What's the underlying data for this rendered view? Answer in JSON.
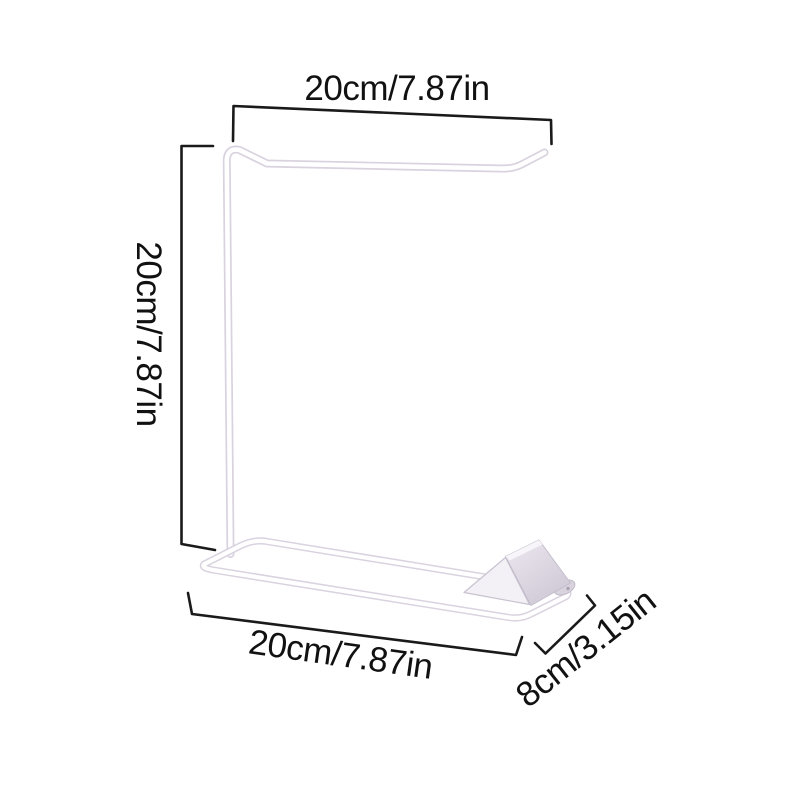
{
  "page": {
    "background_color": "#ffffff",
    "description": "Product dimension diagram of a white metal wire bag/towel stand"
  },
  "product": {
    "name": "white-wire-stand",
    "wire_outline_color": "#d9d2df",
    "wire_fill_color": "#ffffff",
    "plate_light_color": "#e9e4ed",
    "plate_dark_color": "#cfc9d6",
    "plate_tab_color": "#d9d3de",
    "plate_hole_color": "#a9a1b1"
  },
  "dimensions": {
    "line_color": "#1a1a1a",
    "label_color": "#111111",
    "top": {
      "label": "20cm/7.87in"
    },
    "left": {
      "label": "20cm/7.87in"
    },
    "bottom": {
      "label": "20cm/7.87in"
    },
    "depth": {
      "label": "8cm/3.15in"
    }
  }
}
